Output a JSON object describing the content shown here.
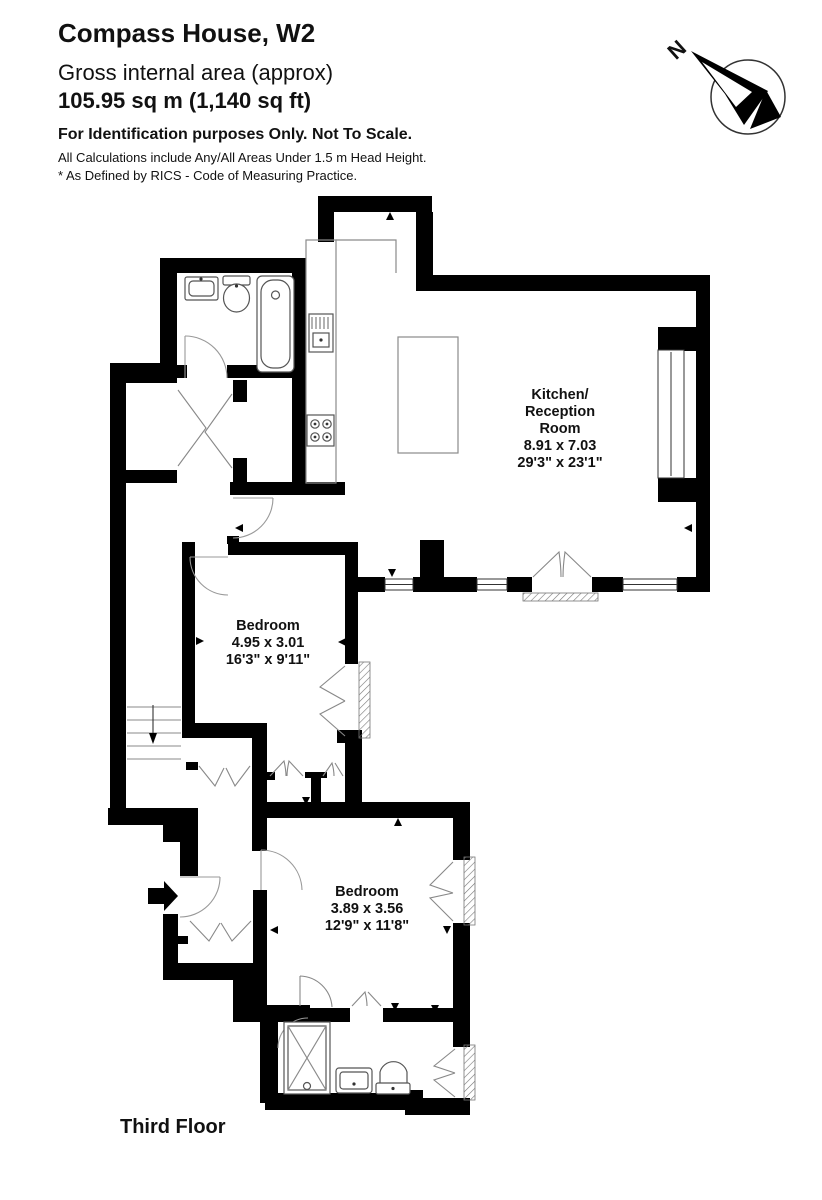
{
  "header": {
    "title": "Compass House, W2",
    "subtitle": "Gross internal area (approx)",
    "area": "105.95 sq m (1,140 sq ft)",
    "disclaimer": "For Identification purposes Only. Not To Scale.",
    "note1": "All Calculations include Any/All Areas Under 1.5 m Head Height.",
    "note2": "* As Defined by RICS - Code of Measuring Practice."
  },
  "compass": {
    "north_label": "N"
  },
  "rooms": [
    {
      "line1": "Kitchen/",
      "line2": "Reception",
      "line3": "Room",
      "metric": "8.91 x 7.03",
      "imperial": "29'3\" x 23'1\""
    },
    {
      "name": "Bedroom",
      "metric": "4.95 x 3.01",
      "imperial": "16'3\" x 9'11\""
    },
    {
      "name": "Bedroom",
      "metric": "3.89 x 3.56",
      "imperial": "12'9\" x 11'8\""
    }
  ],
  "plan": {
    "floor_label": "Third Floor"
  }
}
